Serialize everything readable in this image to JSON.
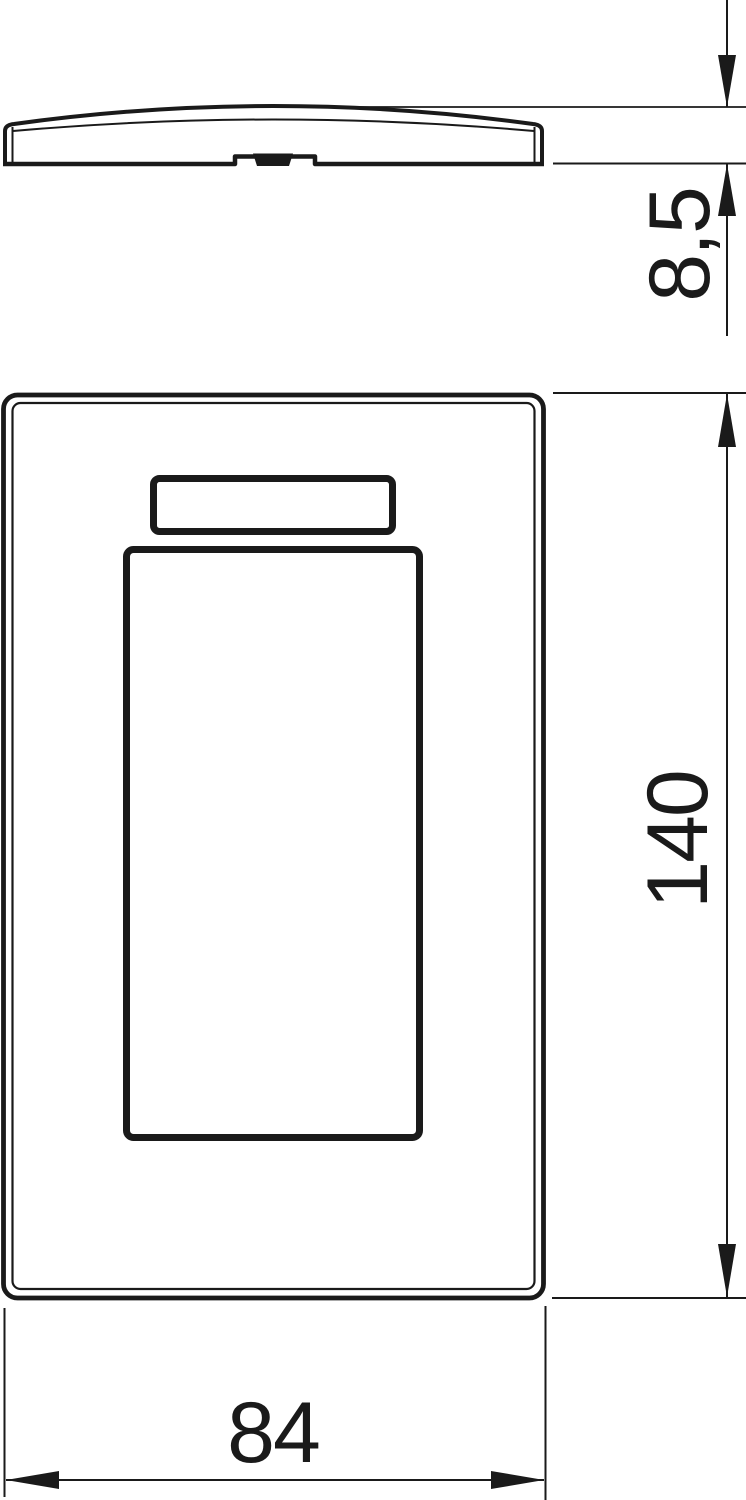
{
  "drawing": {
    "kind": "technical-dimension-drawing",
    "subject": "cover-plate-with-labelling-field-and-module-opening",
    "views": {
      "side_profile": "top",
      "front": "middle"
    },
    "dimensions": {
      "profile_height": "8,5",
      "front_height": "140",
      "front_width": "84"
    }
  },
  "colors": {
    "line": "#1a1a1a",
    "background": "#ffffff"
  }
}
